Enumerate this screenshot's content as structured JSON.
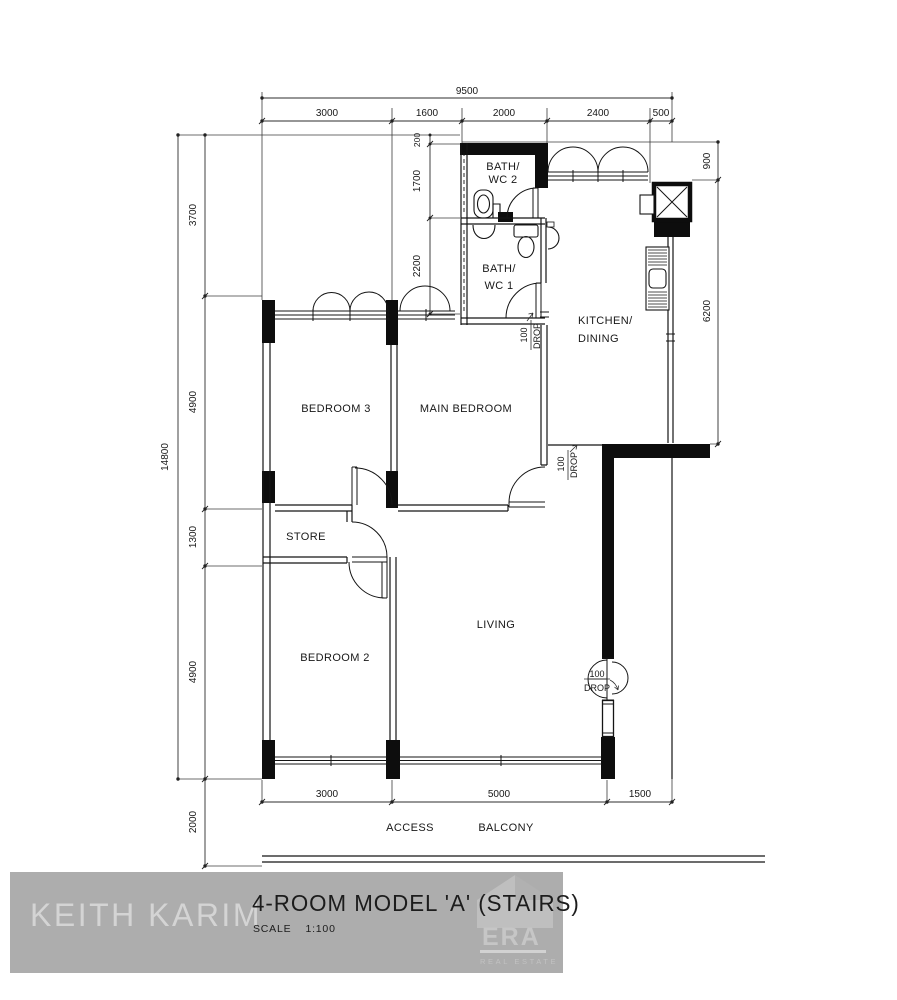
{
  "colors": {
    "ink": "#111111",
    "thin_line": "#333333",
    "bar_bg": "#adadad",
    "watermark_text": "#d4d4d4",
    "logo_tint": "#c6c6c6"
  },
  "title_block": {
    "title": "4-ROOM MODEL 'A' (STAIRS)",
    "scale_label": "SCALE",
    "scale_value": "1:100",
    "watermark": "KEITH KARIM",
    "brand_name": "ERA",
    "brand_tagline": "REAL ESTATE"
  },
  "rooms": {
    "bath2": [
      "BATH/",
      "WC 2"
    ],
    "bath1": [
      "BATH/",
      "WC 1"
    ],
    "kitchen": [
      "KITCHEN/",
      "DINING"
    ],
    "bedroom3": "BEDROOM 3",
    "main_bedroom": "MAIN BEDROOM",
    "store": "STORE",
    "living": "LIVING",
    "bedroom2": "BEDROOM 2"
  },
  "labels": {
    "access": "ACCESS",
    "balcony": "BALCONY"
  },
  "dims": {
    "overall_width": "9500",
    "top": [
      "3000",
      "1600",
      "2000",
      "2400",
      "500"
    ],
    "overall_height": "14800",
    "left": [
      "3700",
      "4900",
      "1300",
      "4900",
      "2000"
    ],
    "bath_col": [
      "200",
      "1700",
      "2200"
    ],
    "right": [
      "900",
      "6200"
    ],
    "bottom": [
      "3000",
      "5000",
      "1500"
    ]
  },
  "annotations": {
    "drop_value": "100",
    "drop_word": "DROP"
  }
}
